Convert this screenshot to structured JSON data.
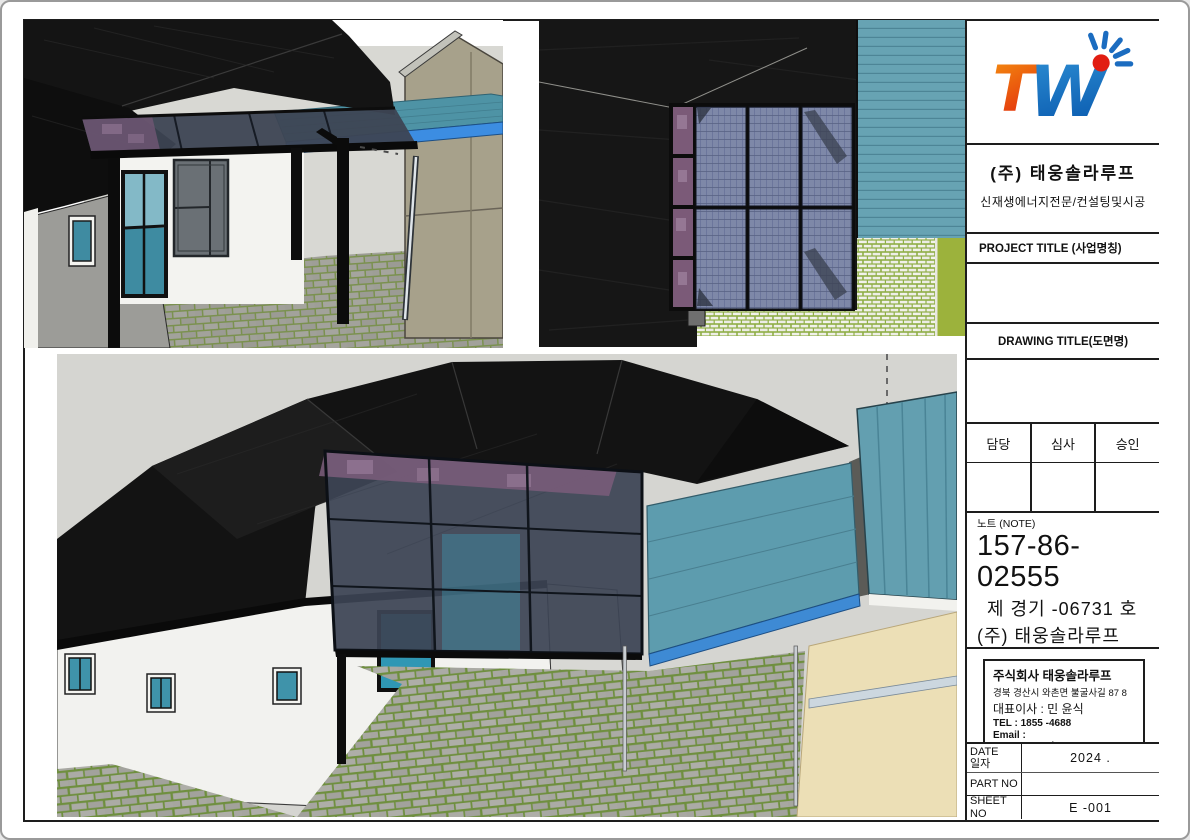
{
  "title_block": {
    "logo": {
      "t": "T",
      "w": "W",
      "orange": "#f5930f",
      "orange_deep": "#e3300e",
      "blue": "#1b6cc0",
      "blue_deep": "#0b5cb0",
      "dot_red": "#e11d12"
    },
    "company_name": "(주) 태웅솔라루프",
    "company_subtitle": "신재생에너지전문/컨설팅및시공",
    "project_title_label": "PROJECT TITLE (사업명칭)",
    "project_title_value": "",
    "drawing_title_label": "DRAWING TITLE(도면명)",
    "drawing_title_value": "",
    "approval": {
      "headers": [
        "담당",
        "심사",
        "승인"
      ],
      "values": [
        "",
        "",
        ""
      ]
    },
    "note": {
      "label": "노트 (NOTE)",
      "number": "157-86-02555",
      "line1": "제 경기 -06731 호",
      "line2": "(주) 태웅솔라루프",
      "line3": "경북 경산시 와촌면 불굴사길 87-8",
      "line4_left": "건설업",
      "line4_right": "전기공사업"
    },
    "company_box": {
      "name": "주식회사  태웅솔라루프",
      "address": "경북 경산시 와촌면 불굴사길 87 8",
      "ceo": "대표이사 : 민 윤식",
      "tel": "TEL : 1855 -4688",
      "email": "Email : taewoongsolar@naver.com"
    },
    "meta_rows": [
      {
        "label": "DATE",
        "label2": "일자",
        "value": "2024 ."
      },
      {
        "label": "PART NO",
        "label2": "",
        "value": ""
      },
      {
        "label": "SHEET NO",
        "label2": "",
        "value": "E -001"
      }
    ]
  },
  "viewports": {
    "view1": {
      "name": "perspective courtyard view of solar canopy"
    },
    "view2": {
      "name": "top plan view of solar panel canopy"
    },
    "view3": {
      "name": "aerial overview of house and canopy"
    }
  },
  "colors": {
    "sheet_border": "#1d1d1d",
    "roof_black": "#141414",
    "teal_roof": "#5d9cae",
    "blue_fascia": "#3d8ee0",
    "solar_panel": "#7e88a8",
    "purple_strip": "#7a5c7a",
    "grass_green": "#9cb23c",
    "paver_joint": "#6f8f3f",
    "tan_wall": "#ecdfb6",
    "sky_gray": "#d5d5d1"
  }
}
